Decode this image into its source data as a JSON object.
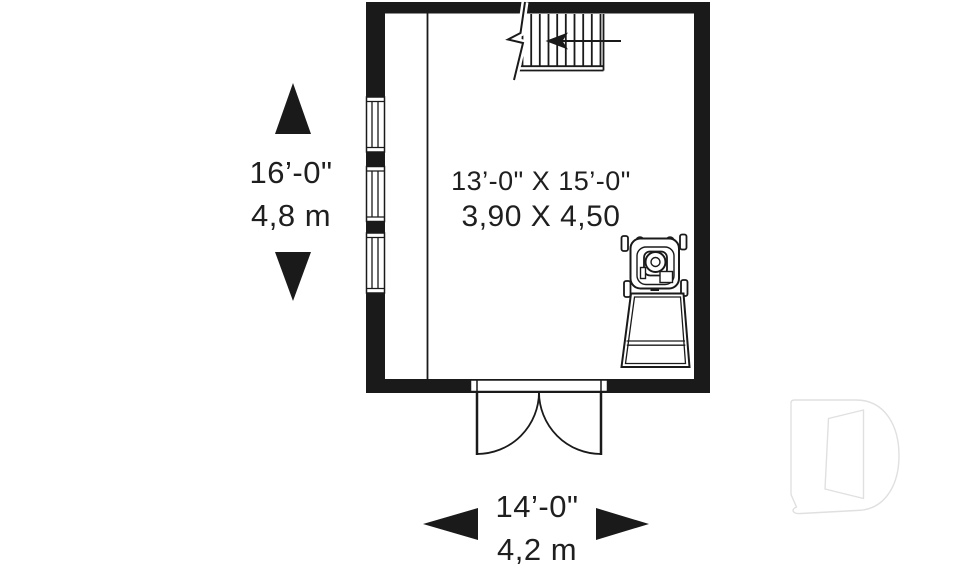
{
  "plan": {
    "type": "floor-plan",
    "room": {
      "size_imperial": "13’-0\" X 15’-0\"",
      "size_metric": "3,90 X 4,50"
    },
    "dimension_vertical": {
      "imperial": "16’-0\"",
      "metric": "4,8 m"
    },
    "dimension_horizontal": {
      "imperial": "14’-0\"",
      "metric": "4,2 m"
    },
    "features": [
      "staircase with up-direction arrow and break line",
      "three windows on left wall",
      "double swing door on bottom wall",
      "riding lawn mower symbol",
      "interior wall line"
    ],
    "icons": [
      "up-arrow-icon",
      "down-arrow-icon",
      "left-arrow-icon",
      "right-arrow-icon",
      "stair-direction-arrow-icon",
      "drummond-logo-watermark"
    ],
    "colors": {
      "line": "#1a1a1a",
      "wall": "#1a1a1a",
      "background": "#ffffff",
      "watermark": "#e0e0e0"
    }
  }
}
